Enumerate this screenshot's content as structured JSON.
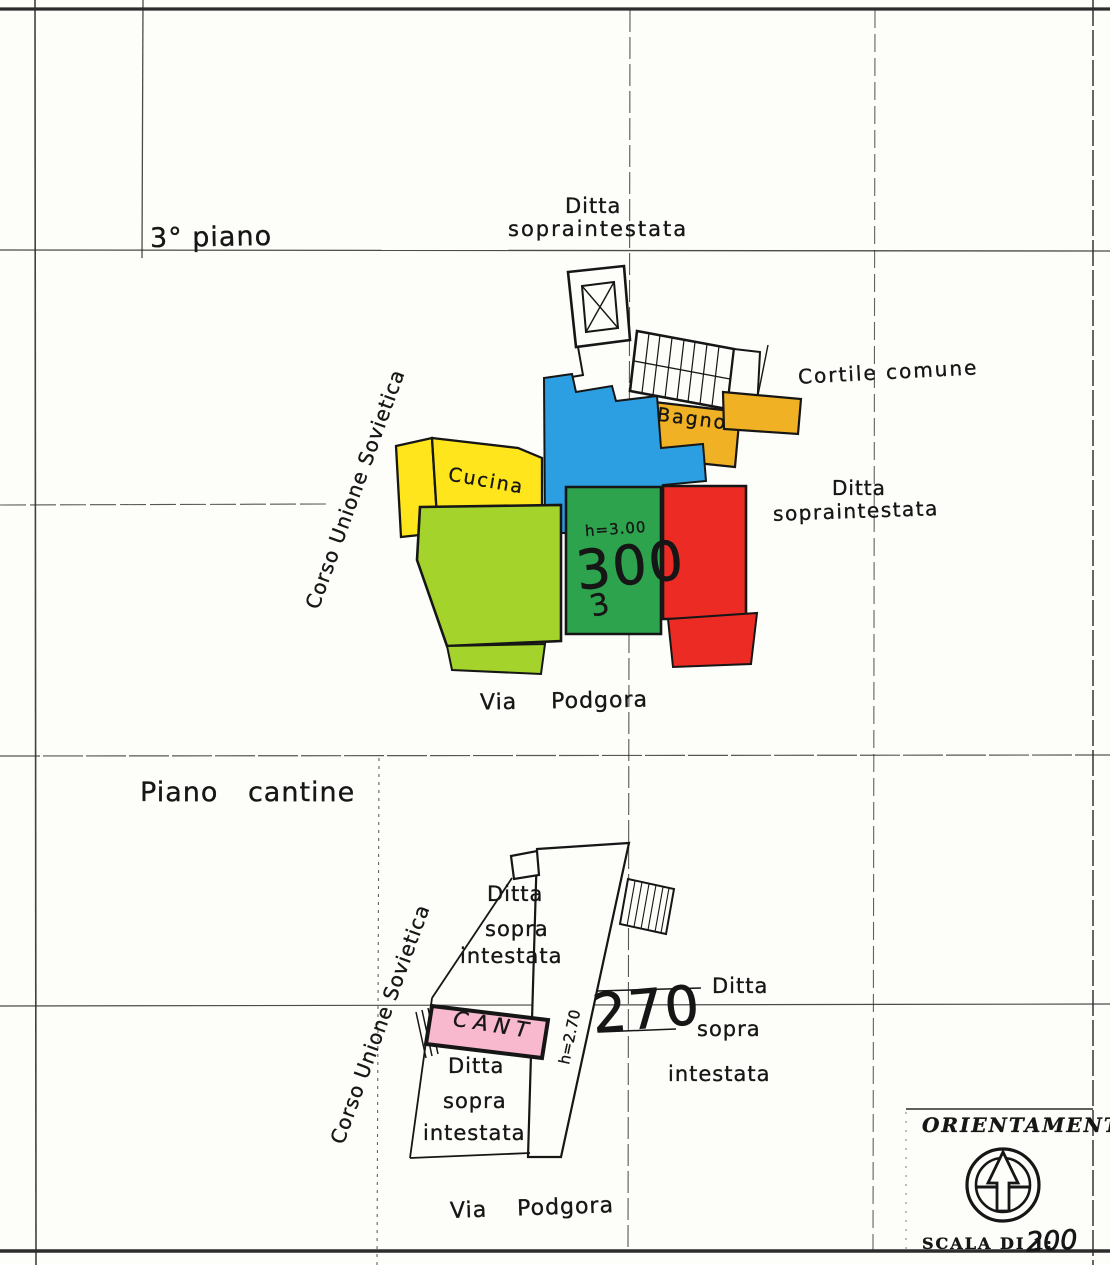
{
  "upper_plan": {
    "title": "3° piano",
    "ditta_top": {
      "l1": "Ditta",
      "l2": "sopraintestata"
    },
    "cortile": "Cortile comune",
    "cucina": "Cucina",
    "bagno": "Bagno",
    "height_note": "h=3.00",
    "unit_number": "300",
    "unit_note": "3",
    "ditta_right": {
      "l1": "Ditta",
      "l2": "sopraintestata"
    },
    "street_left": "Corso Unione Sovietica",
    "street_bottom": "Via Podgora"
  },
  "lower_plan": {
    "title": "Piano cantine",
    "street_left": "Corso Unione Sovietica",
    "ditta_upper": {
      "l1": "Ditta",
      "l2": "sopra",
      "l3": "intestata"
    },
    "unit_number": "270",
    "ditta_right": {
      "l1": "Ditta",
      "l2": "sopra",
      "l3": "intestata"
    },
    "cant": "CANT",
    "height_note": "h=2.70",
    "ditta_lower": {
      "l1": "Ditta",
      "l2": "sopra",
      "l3": "intestata"
    },
    "street_bottom": "Via Podgora"
  },
  "orientation_box": {
    "title": "ORIENTAMENTO",
    "scale_label": "SCALA DI 1:",
    "scale_value": "200",
    "compass_icon": "north-arrow-compass"
  },
  "colors": {
    "paper": "#fdfdfa",
    "ink": "#161616",
    "room_yellow": "#FFE51C",
    "room_orange": "#F0B125",
    "room_blue": "#2C9FE2",
    "room_green": "#2EA34E",
    "room_light_green": "#A4D42C",
    "room_red": "#EC2B24",
    "room_pink": "#F8B9CE"
  }
}
